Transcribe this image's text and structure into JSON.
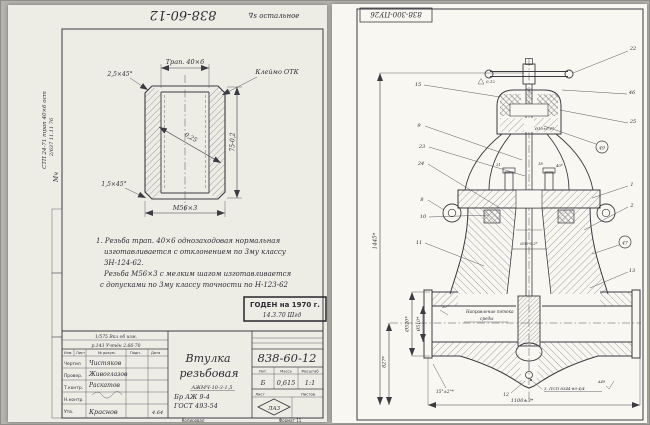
{
  "left": {
    "flip_number": "838-60-12",
    "finish_note": "∇s остальное",
    "margin": {
      "l1": "СТП 24-71 трап 40×6 ост",
      "l2": "2/637  11.11  76",
      "l3": "Мч"
    },
    "dims": {
      "chamfer_top": "2,5×45°",
      "thread_top": "Трап. 40×6",
      "stamp": "Клеймо ОТК",
      "height": "75-0,2",
      "radius": "0,25",
      "chamfer_bot": "1,5×45°",
      "thread_bot": "М56×3"
    },
    "notes": {
      "n1": "1. Резьба трап. 40×6 однозаходовая  нормальная",
      "n2": "изготавливается с отклонением по 3му классу",
      "n3": "ЗН-124-62.",
      "n4": "Резьба М56×3 с мелким шагом изготавливается",
      "n5": "с допусками по 3му классу точности по Н-123-62"
    },
    "stamp": {
      "l1": "ГОДЕН на 1970 г.",
      "l2": "14.3.70  Шгд"
    },
    "tb": {
      "change1": "1/575 Вкл об изм.",
      "change2": "р.143 Учтён 2.66-70",
      "h1": "Изм.",
      "h2": "Лист",
      "h3": "№ докум.",
      "h4": "Подп.",
      "h5": "Дата",
      "r1": "Чертил",
      "r2": "Провер.",
      "r3": "Т.контр.",
      "r4": "Н.контр.",
      "r5": "Утв.",
      "n1": "Чистяков",
      "n2": "Живоглазов",
      "n3": "Раскатов",
      "n4": "Краснов",
      "date": "4.64",
      "title1": "Втулка",
      "title2": "резьбовая",
      "mat1": "АЖМЧ-10-3-1,5",
      "mat2": "Бр АЖ 9-4",
      "mat3": "ГОСТ 493-54",
      "num": "838-60-12",
      "lith": "Лит.",
      "massh": "Масса",
      "scaleh": "Масштаб",
      "lit": "Б",
      "mass": "0,615",
      "scale": "1:1",
      "sheet": "Лист",
      "sheets": "Листов",
      "diamond": "ЛА3",
      "copied": "Копировал",
      "format": "Формат 11"
    }
  },
  "right": {
    "flip_number": "838-300-ПУ26",
    "callL": {
      "c15": "15",
      "c9": "9",
      "c23": "23",
      "c24": "24",
      "c8": "8",
      "c10": "10",
      "c11": "11"
    },
    "callR": {
      "c22": "22",
      "c46": "46",
      "c25": "25",
      "c49": "49",
      "c1": "1",
      "c2": "2",
      "c47": "47",
      "c13": "13",
      "c12": "12"
    },
    "dims": {
      "total": "1445*",
      "axis": "827*",
      "dout": "Ø520*",
      "din": "Ø510*",
      "a30": "30°",
      "a15": "15°±2°*",
      "len": "1100±3*",
      "stem": "Ø30-0,2*",
      "fit": "Ø10±0,1*",
      "s21": "21",
      "s18": "18",
      "s40": "40*",
      "s012": "0,12"
    },
    "flow1": "Направление потока",
    "flow2": "среды",
    "weld": "3, ПСП 8344-80-4/4",
    "weld_mark": "А49"
  }
}
